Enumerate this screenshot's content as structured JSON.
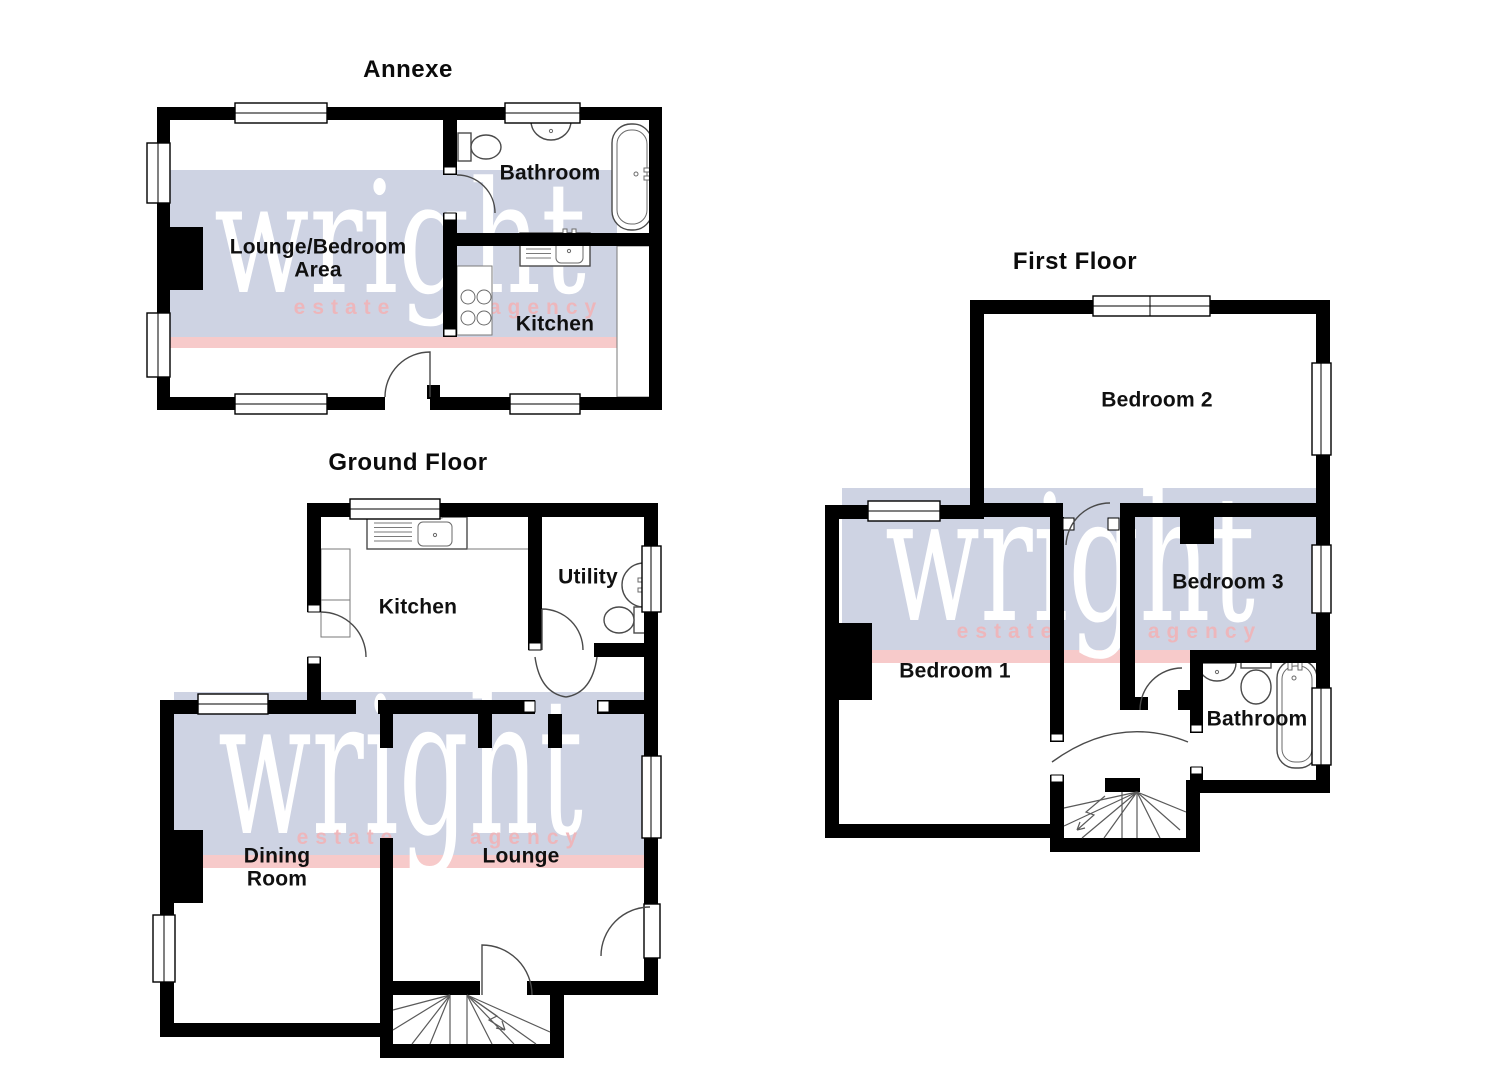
{
  "watermark": {
    "brand": "wright",
    "word_left": "estate",
    "word_right": "agency",
    "band_color": "#ced3e3",
    "stripe_color": "#f7caca",
    "brand_color": "#ffffff",
    "words_color": "#f0b4b8"
  },
  "colors": {
    "wall": "#000000",
    "floor": "#ffffff",
    "label_text": "#101010",
    "fixture_line": "#4a4a4a"
  },
  "floors": {
    "annexe": {
      "title": "Annexe",
      "rooms": {
        "bathroom": "Bathroom",
        "lounge_bedroom": "Lounge/Bedroom\nArea",
        "kitchen": "Kitchen"
      }
    },
    "ground": {
      "title": "Ground Floor",
      "rooms": {
        "kitchen": "Kitchen",
        "utility": "Utility",
        "dining": "Dining\nRoom",
        "lounge": "Lounge"
      }
    },
    "first": {
      "title": "First Floor",
      "rooms": {
        "bedroom2": "Bedroom 2",
        "bedroom1": "Bedroom 1",
        "bedroom3": "Bedroom 3",
        "bathroom": "Bathroom"
      }
    }
  }
}
